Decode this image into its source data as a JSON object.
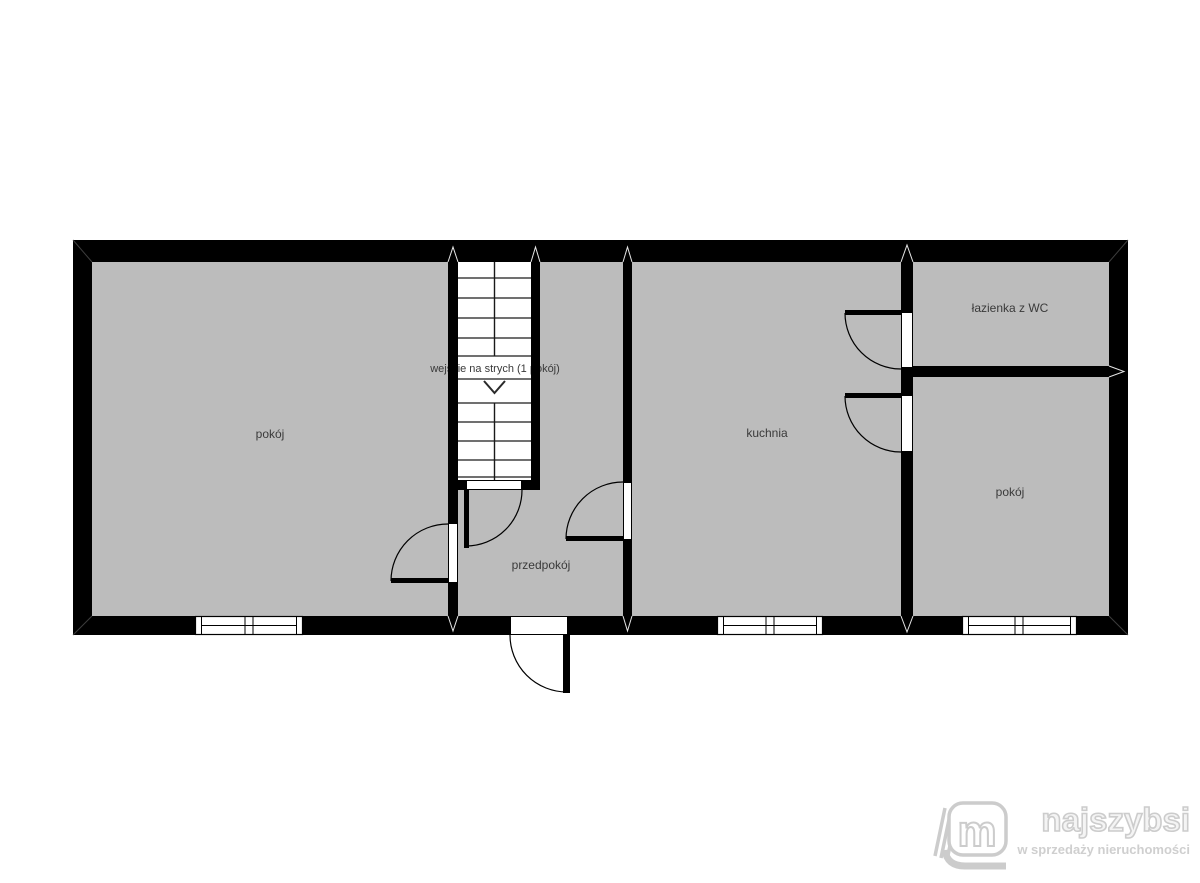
{
  "plan": {
    "rooms": [
      {
        "id": "pokoj-left",
        "label": "pokój"
      },
      {
        "id": "attic-stairs",
        "label": "wejście na strych (1 pokój)"
      },
      {
        "id": "przedpokoj",
        "label": "przedpokój"
      },
      {
        "id": "kuchnia",
        "label": "kuchnia"
      },
      {
        "id": "lazienka",
        "label": "łazienka z WC"
      },
      {
        "id": "pokoj-right",
        "label": "pokój"
      }
    ]
  },
  "branding": {
    "name": "najszybsi",
    "tagline": "w sprzedaży nieruchomości",
    "icon_letter": "m"
  },
  "colors": {
    "wall": "#000000",
    "floor": "#bcbcbc",
    "background": "#ffffff",
    "label_text": "#3a3a3a",
    "logo_gray": "#cccccc"
  }
}
